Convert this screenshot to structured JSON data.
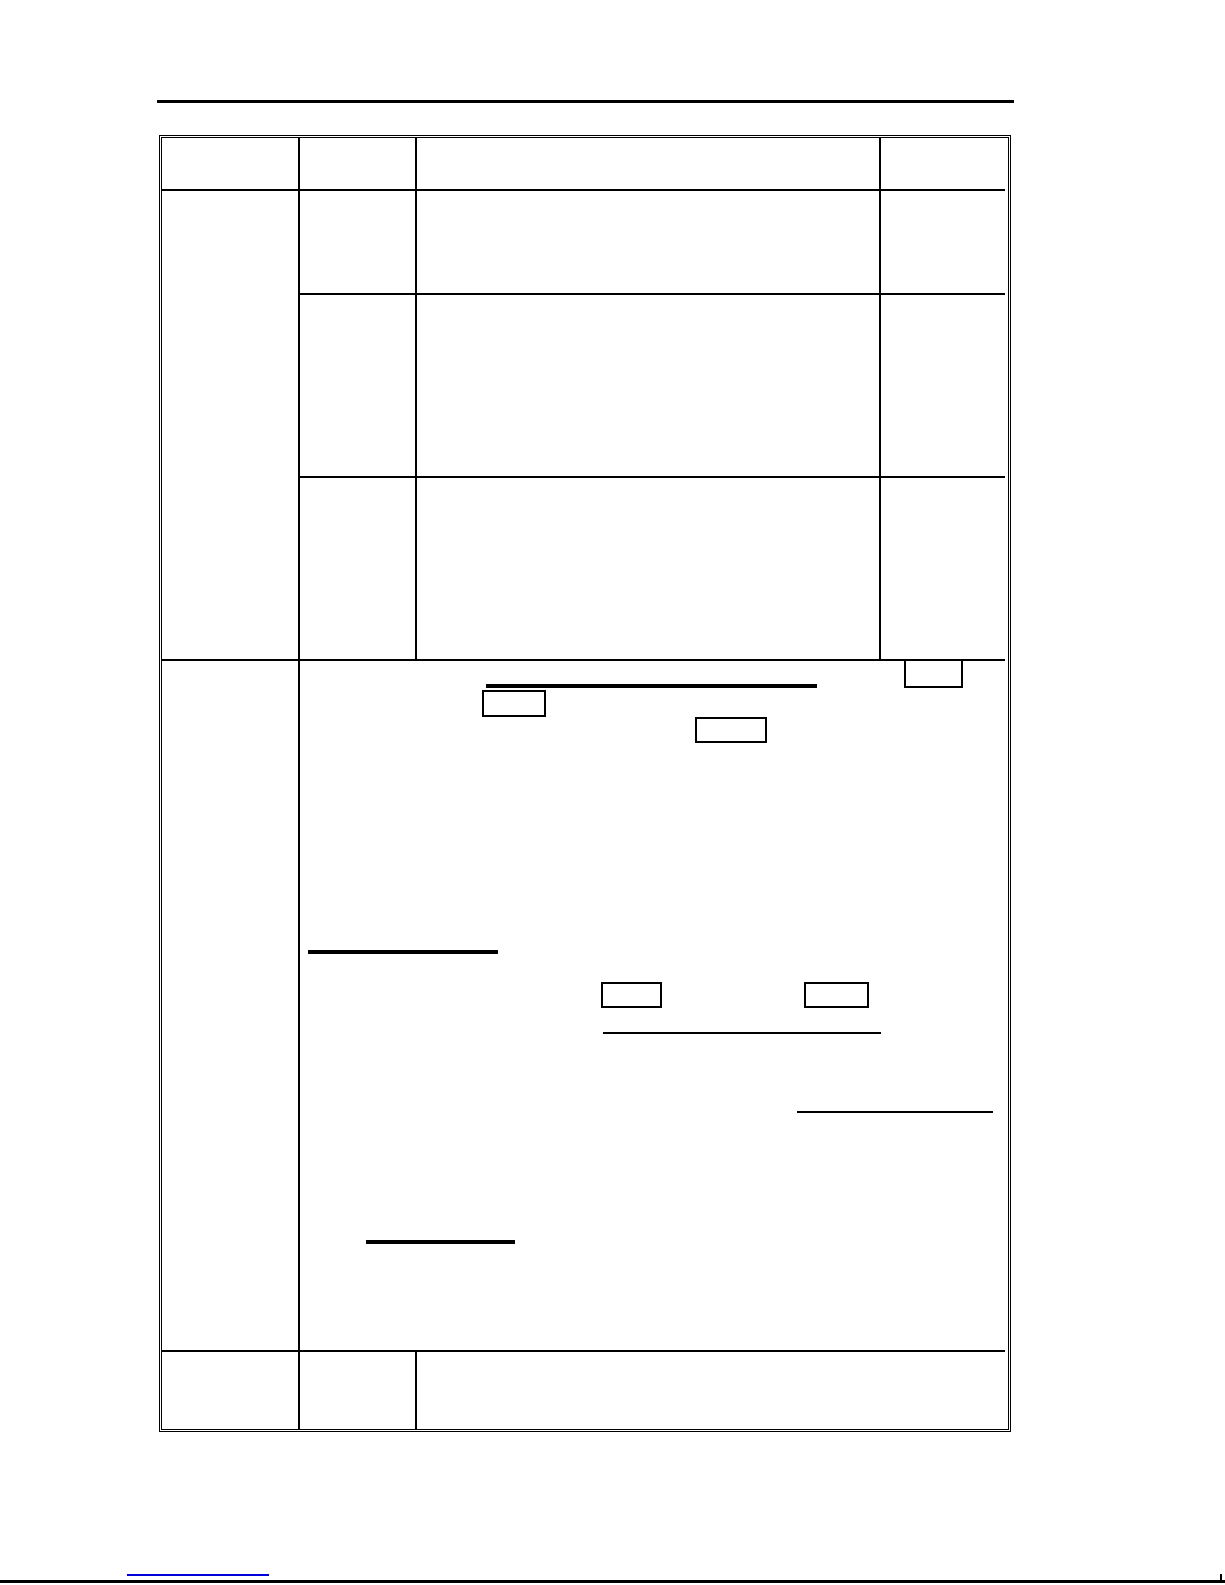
{
  "page": {
    "kind": "blank document page containing an empty table template",
    "background": "#ffffff"
  },
  "colors": {
    "rule_and_table_lines": "#000000",
    "link_underline": "#0000dd"
  },
  "table": {
    "column_count": 4,
    "row_count": 6,
    "all_cells_empty": true,
    "merged_cells": [
      "first column spans body rows 1-3",
      "large content cell spans columns 2-4 in row 5",
      "columns 3-4 merged in last row"
    ]
  },
  "content_cell": {
    "empty_boxes": 5,
    "blank_underlines": 5
  },
  "footer": {
    "hyperlink_visible_text": ""
  }
}
